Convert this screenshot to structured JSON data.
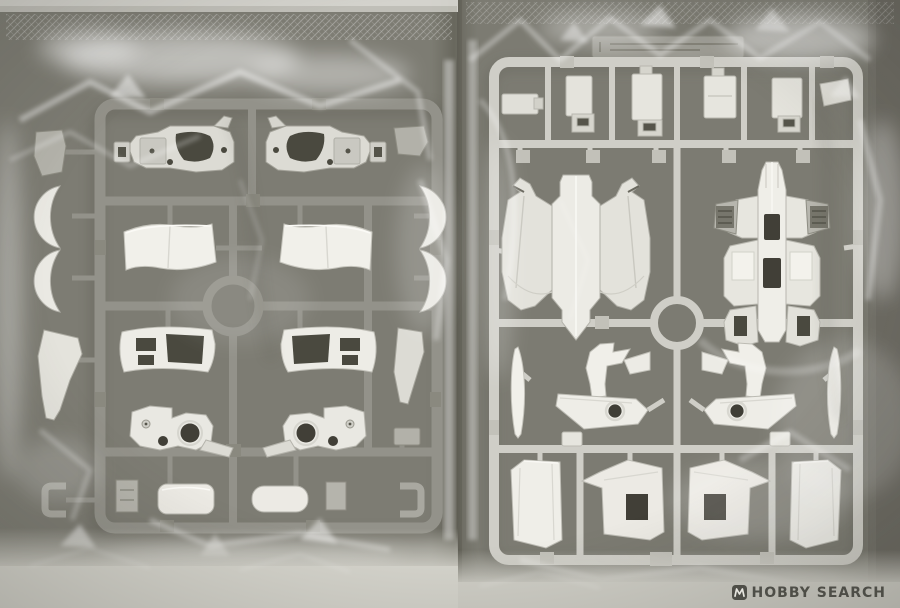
{
  "photo": {
    "subject": "Two plastic model-kit runners (sprues) sealed in clear poly bags, lying inside a kit box",
    "watermark": {
      "label": "HOBBY SEARCH",
      "icon": "hobby-search-logo"
    },
    "palette": {
      "box_interior": "#78776e",
      "bag_gap_shadow": "#5e5d53",
      "left_runner_frame": "#93928a",
      "left_runner_parts": "#eceae4",
      "left_small_parts_grey": "#b5b4ac",
      "right_runner_frame": "#cfcec7",
      "right_runner_parts": "#f1f0ea",
      "cutout_shadow": "#4a493f",
      "bag_highlight": "#ffffff",
      "bottom_surface_left": "#d5d4cc",
      "bottom_surface_right": "#cfcec6",
      "watermark_color": "#3c3c36"
    },
    "bags": [
      {
        "side": "left",
        "description": "Grey runner with white armor parts",
        "parts": [
          "arm-bracket (mirrored pair)",
          "shoulder-crescent-armor x4",
          "curved-chest-panel x2",
          "vented-skirt-panel x2",
          "waist-joint-frame (mirrored pair)",
          "tapered-leg-cone x2",
          "corner-u-clip x2",
          "round-cap-plate x2",
          "connector-block x4"
        ]
      },
      {
        "side": "right",
        "description": "Light runner with winged backpack shells and leg parts",
        "parts": [
          "runner-name-plate",
          "flat-bracket x6",
          "hanging-tab x5",
          "winged-backpack-back-shell",
          "winged-backpack-front-shell (slotted)",
          "ankle-blade x2",
          "leg-ankle-unit (mirrored pair)",
          "center-fin x2",
          "side-skirt-flare x2",
          "slotted-skirt-plate x2"
        ]
      }
    ]
  }
}
